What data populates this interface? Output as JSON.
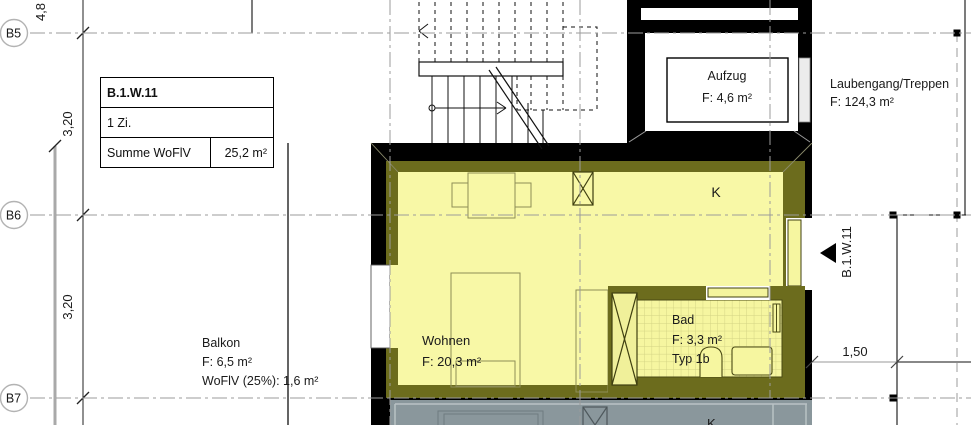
{
  "drawing": {
    "grid_axes": [
      {
        "label": "B5"
      },
      {
        "label": "B6"
      },
      {
        "label": "B7"
      }
    ],
    "dimensions": {
      "top_left_partial": "4,8",
      "b5_b6": "3,20",
      "b6_b7": "3,20",
      "right_offset": "1,50"
    },
    "unit_info_table": {
      "unit_id": "B.1.W.11",
      "rooms": "1 Zi.",
      "sum_label": "Summe WoFlV",
      "sum_value": "25,2 m²"
    },
    "rooms": {
      "elevator": {
        "name": "Aufzug",
        "area": "F: 4,6 m²"
      },
      "walkway": {
        "name": "Laubengang/Treppen",
        "area": "F: 124,3 m²"
      },
      "living": {
        "name": "Wohnen",
        "area": "F: 20,3 m²"
      },
      "kitchen_label": "K",
      "bath": {
        "name": "Bad",
        "area": "F: 3,3 m²",
        "type": "Typ 1b"
      },
      "balcony": {
        "name": "Balkon",
        "area": "F: 6,5 m²",
        "wofiv": "WoFlV (25%): 1,6 m²"
      },
      "lower_unit_kitchen_label": "K"
    },
    "entry_marker": {
      "label": "B.1.W.11"
    },
    "colors": {
      "room_highlight": "#f8f8a6",
      "wall_highlight": "#6c6c1d",
      "lower_unit_fill": "#8a979c",
      "wall": "#000000",
      "grid": "#9b9b9b"
    }
  }
}
